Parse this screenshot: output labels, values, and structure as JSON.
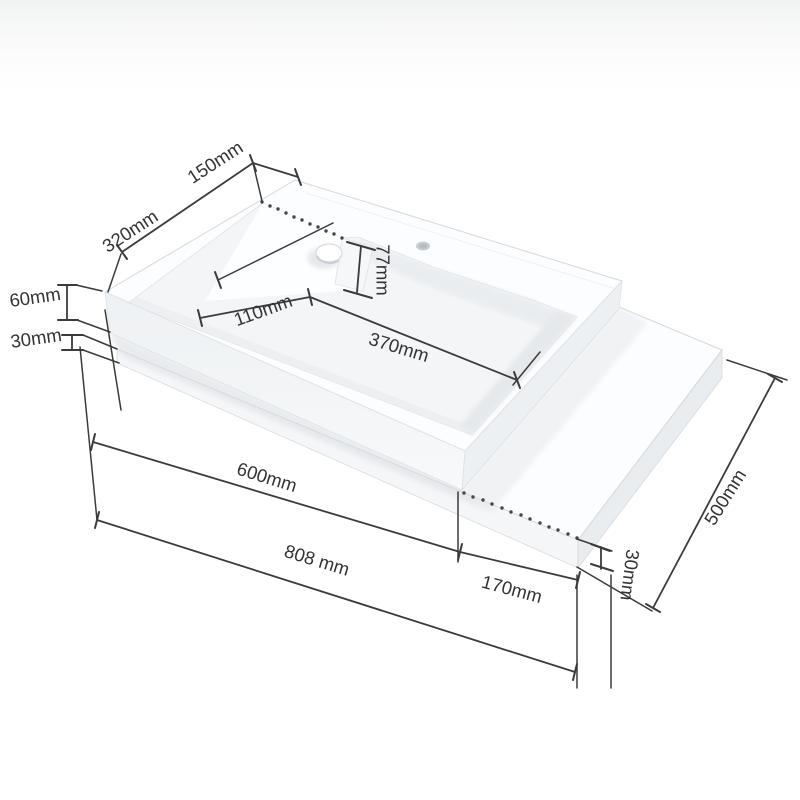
{
  "figure": {
    "kind": "isometric dimension drawing",
    "subject": "wall-mounted washbasin with right-hand counter shelf",
    "background_color": "#ffffff",
    "dimension_line_color": "#3b3b3b",
    "product_color": "#fbfcfe"
  },
  "dimensions": {
    "d150": {
      "label": "150mm"
    },
    "d320": {
      "label": "320mm"
    },
    "d60": {
      "label": "60mm"
    },
    "d30_left": {
      "label": "30mm"
    },
    "d110": {
      "label": "110mm"
    },
    "d77": {
      "label": "77mm"
    },
    "d370": {
      "label": "370mm"
    },
    "d600": {
      "label": "600mm"
    },
    "d808": {
      "label": "808 mm"
    },
    "d170": {
      "label": "170mm"
    },
    "d30_right": {
      "label": "30mm"
    },
    "d500": {
      "label": "500mm"
    }
  }
}
